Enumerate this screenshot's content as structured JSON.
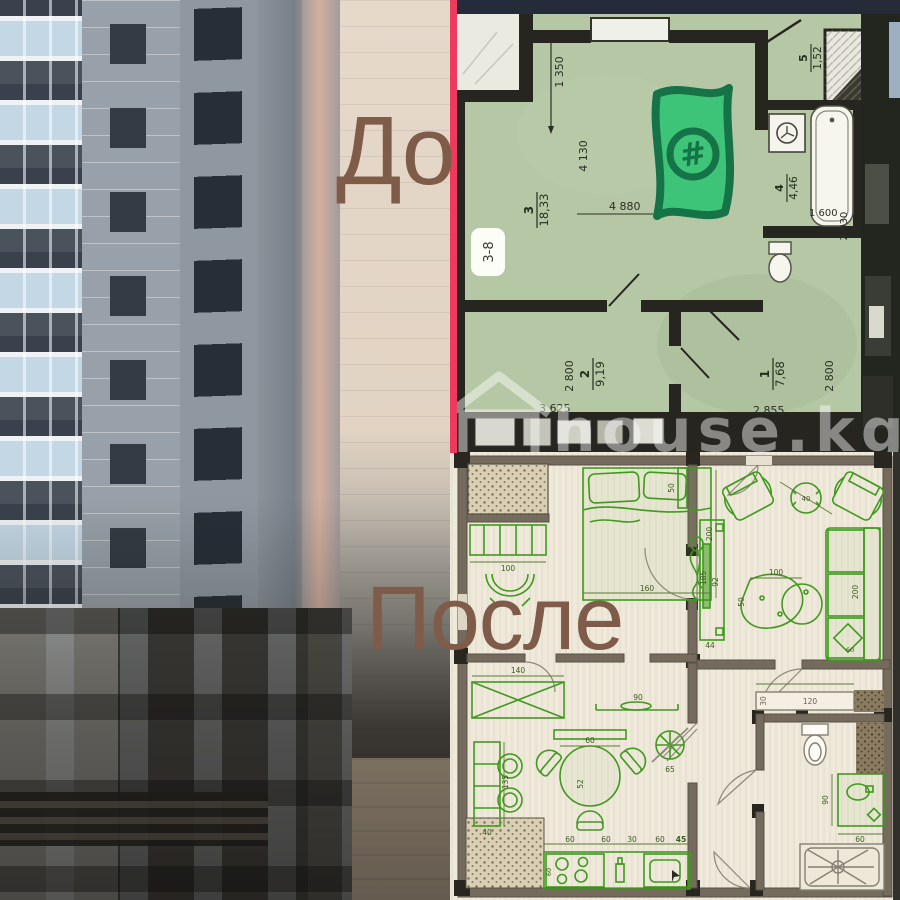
{
  "collage": {
    "before_label": "До",
    "after_label": "После",
    "label_color": "#7f5b49"
  },
  "top_plan": {
    "unit_badge": "3-8",
    "watermark": "house.kg",
    "sticker_glyph": "#",
    "rooms": {
      "r3": {
        "num": "3",
        "area": "18,33"
      },
      "r5": {
        "num": "5",
        "area": "1,52"
      },
      "r4": {
        "num": "4",
        "area": "4,46"
      },
      "r2": {
        "num": "2",
        "area": "9,19"
      },
      "r1": {
        "num": "1",
        "area": "7,68"
      }
    },
    "dims": {
      "w1350": "1 350",
      "w4130": "4 130",
      "w4880": "4 880",
      "w1600": "1 600",
      "w2930": "2 930",
      "w3625": "3 625",
      "w2800a": "2 800",
      "w2855": "2 855",
      "w2800b": "2 800"
    },
    "colors": {
      "background": "#b5c7a4",
      "walls": "#26251f",
      "sticker_green": "#3ec478",
      "sticker_outline": "#157347",
      "divider_red": "#ee3a5c",
      "status_bar": "#262b3a"
    }
  },
  "bottom_plan": {
    "dims": {
      "bed_width": "160",
      "bed_length": "200",
      "bed_shelf": "50",
      "dresser": "100",
      "side_table": "40",
      "tv_panel": "185",
      "tv_length": "92",
      "tv_offset": "44",
      "coffee_table": "100",
      "coffee_depth": "50",
      "sofa_length": "200",
      "sofa_pillow": "60",
      "wardrobe": "140",
      "wall_shelf": "90",
      "dining_table": "60",
      "dining_depth": "52",
      "cabinet_height": "135",
      "cabinet_width": "40",
      "fan": "65",
      "stove": "60",
      "counter_1": "60",
      "counter_2": "60",
      "counter_3": "30",
      "counter_4": "60",
      "counter_5": "45",
      "bath_shelf": "120",
      "bath_shelf_depth": "30",
      "vanity": "90",
      "vanity_width": "60"
    },
    "colors": {
      "paper": "#efe9da",
      "ink_green": "#3f9a1e",
      "walls": "#756b5d"
    }
  },
  "icons": {
    "money_sticker": "dollar-banknote-sticker",
    "washing_machine": "washing-machine-icon",
    "bathtub": "bathtub-icon",
    "toilet": "toilet-icon",
    "fan": "ventilation-fan-icon",
    "shower": "shower-tray-icon",
    "house_watermark": "house-logo-icon"
  }
}
